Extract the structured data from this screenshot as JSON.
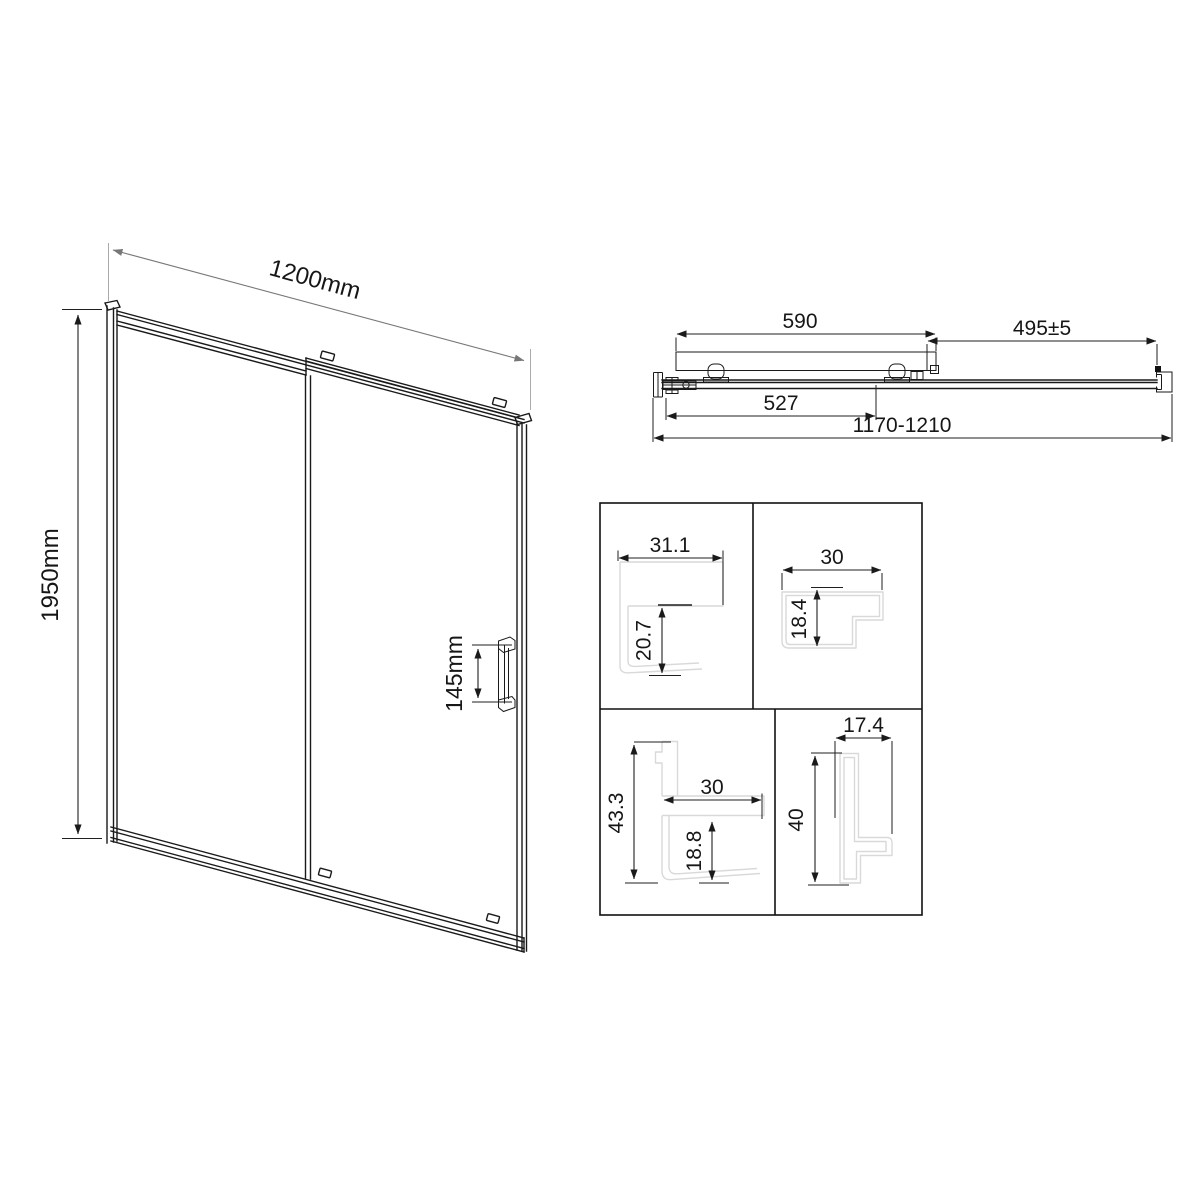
{
  "front_view": {
    "width_label": "1200mm",
    "height_label": "1950mm",
    "handle_height_label": "145mm"
  },
  "top_view": {
    "door_panel_width_label": "590",
    "entry_width_label": "495±5",
    "rail_width_label": "527",
    "overall_adjustment_label": "1170-1210"
  },
  "profile_details": {
    "wall_profile": {
      "width": "31.1",
      "depth": "20.7"
    },
    "top_rail_profile": {
      "width": "30",
      "depth": "18.4"
    },
    "frame_profile": {
      "height": "43.3",
      "width": "30",
      "depth": "18.8"
    },
    "door_stile_profile": {
      "width": "17.4",
      "height": "40"
    }
  },
  "colors": {
    "line": "#1a1a1a",
    "profile_outline": "#d9d9d9",
    "background": "#ffffff"
  }
}
